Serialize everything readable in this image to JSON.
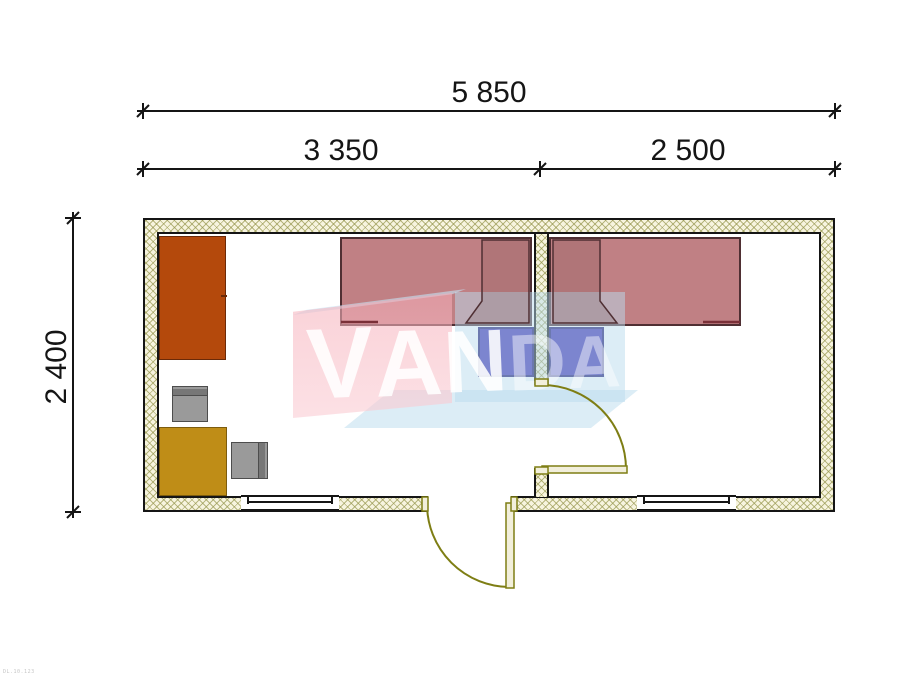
{
  "dimensions": {
    "overall_width_mm": "5 850",
    "left_section_mm": "3 350",
    "right_section_mm": "2 500",
    "depth_mm": "2 400"
  },
  "watermark": {
    "text": "VANDA",
    "letters": [
      "V",
      "A",
      "N",
      "D",
      "A"
    ]
  },
  "corner_note": "DL.10.123",
  "plan": {
    "rooms": [
      {
        "name": "room-left"
      },
      {
        "name": "room-right"
      }
    ],
    "furniture": [
      {
        "name": "wardrobe",
        "color": "#b4490c"
      },
      {
        "name": "desk-table",
        "color": "#bf8d17"
      },
      {
        "name": "stool-1",
        "color": "#9a9a9a"
      },
      {
        "name": "stool-2",
        "color": "#9a9a9a"
      },
      {
        "name": "bed-left",
        "color": "#c08084"
      },
      {
        "name": "bed-right",
        "color": "#c08084"
      },
      {
        "name": "nightstand-left",
        "color": "#3f2eb0"
      },
      {
        "name": "nightstand-right",
        "color": "#3f2eb0"
      }
    ],
    "doors": [
      {
        "name": "entrance-door",
        "color": "#7e7e14"
      },
      {
        "name": "interior-door",
        "color": "#7e7e14"
      }
    ],
    "windows": [
      {
        "name": "window-left"
      },
      {
        "name": "window-right"
      }
    ],
    "colors": {
      "wall_hatch": "#94944a",
      "wall_line": "#151515"
    }
  }
}
